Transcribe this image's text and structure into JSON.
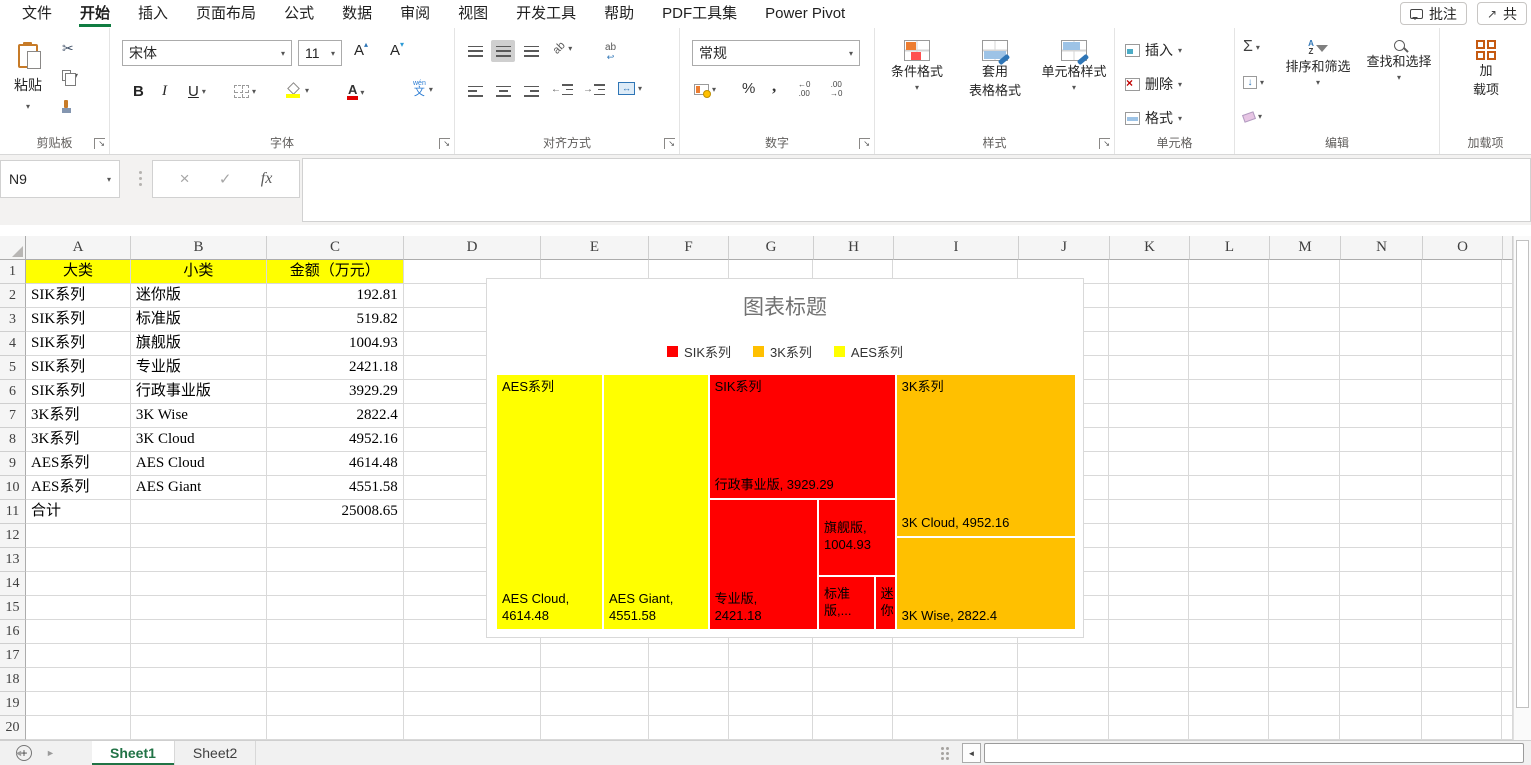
{
  "titlebar": {
    "tabs": [
      "文件",
      "开始",
      "插入",
      "页面布局",
      "公式",
      "数据",
      "审阅",
      "视图",
      "开发工具",
      "帮助",
      "PDF工具集",
      "Power Pivot"
    ],
    "active_tab": "开始",
    "comments_button": "批注",
    "share_button": "共"
  },
  "icons": {
    "dropdown": "▾",
    "launcher": "↘",
    "caret_up": "▴",
    "caret_down": "▾",
    "scissors": "✂",
    "merge_arrows": "↔",
    "wrap_ab": "ab",
    "wrap_return": "↩",
    "orient_ab": "ab",
    "indent_left": "←",
    "indent_right": "→",
    "sum": "Σ",
    "fill_down": "↓",
    "percent": "%",
    "comma": ",",
    "inc_decimal_top": "←0",
    "inc_decimal_bottom": ".00",
    "dec_decimal_top": ".00",
    "dec_decimal_bottom": "→0",
    "sort_a": "A",
    "sort_z": "Z",
    "cancel": "×",
    "enter": "✓",
    "fx": "fx",
    "nav_prev": "◄",
    "nav_next": "►",
    "scroll_left": "◄",
    "share_arrow": "↗"
  },
  "ribbon": {
    "clipboard": {
      "paste_label": "粘贴",
      "group_label": "剪贴板"
    },
    "font": {
      "font_name": "宋体",
      "font_size": "11",
      "bold": "B",
      "italic": "I",
      "underline": "U",
      "grow_letter": "A",
      "shrink_letter": "A",
      "color_letter": "A",
      "pinyin_top": "wén",
      "pinyin_bottom": "文",
      "group_label": "字体"
    },
    "alignment": {
      "group_label": "对齐方式"
    },
    "number": {
      "format_selected": "常规",
      "group_label": "数字"
    },
    "styles": {
      "conditional": "条件格式",
      "format_as_table_l1": "套用",
      "format_as_table_l2": "表格格式",
      "cell_styles": "单元格样式",
      "group_label": "样式"
    },
    "cells": {
      "insert": "插入",
      "delete": "删除",
      "format": "格式",
      "group_label": "单元格"
    },
    "editing": {
      "sort_filter": "排序和筛选",
      "find_select": "查找和选择",
      "group_label": "编辑"
    },
    "addins": {
      "button_l1": "加",
      "button_l2": "载项",
      "group_label": "加载项"
    }
  },
  "formula_bar": {
    "name_box": "N9",
    "formula_value": ""
  },
  "sheet": {
    "columns": [
      "A",
      "B",
      "C",
      "D",
      "E",
      "F",
      "G",
      "H",
      "I",
      "J",
      "K",
      "L",
      "M",
      "N",
      "O"
    ],
    "row_count": 20,
    "header_cells": [
      "大类",
      "小类",
      "金额（万元）"
    ],
    "header_fill": "#FFFF00",
    "data_rows": [
      {
        "row": 2,
        "A": "SIK系列",
        "B": "迷你版",
        "C": "192.81"
      },
      {
        "row": 3,
        "A": "SIK系列",
        "B": "标准版",
        "C": "519.82"
      },
      {
        "row": 4,
        "A": "SIK系列",
        "B": "旗舰版",
        "C": "1004.93"
      },
      {
        "row": 5,
        "A": "SIK系列",
        "B": "专业版",
        "C": "2421.18"
      },
      {
        "row": 6,
        "A": "SIK系列",
        "B": "行政事业版",
        "C": "3929.29"
      },
      {
        "row": 7,
        "A": "3K系列",
        "B": "3K Wise",
        "C": "2822.4"
      },
      {
        "row": 8,
        "A": "3K系列",
        "B": "3K Cloud",
        "C": "4952.16"
      },
      {
        "row": 9,
        "A": "AES系列",
        "B": "AES  Cloud",
        "C": "4614.48"
      },
      {
        "row": 10,
        "A": "AES系列",
        "B": "AES  Giant",
        "C": "4551.58"
      },
      {
        "row": 11,
        "A": "合计",
        "B": "",
        "C": "25008.65"
      }
    ],
    "tabs": [
      "Sheet1",
      "Sheet2"
    ],
    "active_sheet": "Sheet1",
    "new_sheet_glyph": "+"
  },
  "chart_data": {
    "type": "treemap",
    "title": "图表标题",
    "legend_position": "top",
    "legend": [
      {
        "name": "SIK系列",
        "color": "#FF0000"
      },
      {
        "name": "3K系列",
        "color": "#FFC000"
      },
      {
        "name": "AES系列",
        "color": "#FFFF00"
      }
    ],
    "groups": [
      {
        "name": "SIK系列",
        "color": "#FF0000",
        "items": [
          {
            "label": "迷你版",
            "value": 192.81
          },
          {
            "label": "标准版",
            "value": 519.82
          },
          {
            "label": "旗舰版",
            "value": 1004.93
          },
          {
            "label": "专业版",
            "value": 2421.18
          },
          {
            "label": "行政事业版",
            "value": 3929.29
          }
        ]
      },
      {
        "name": "3K系列",
        "color": "#FFC000",
        "items": [
          {
            "label": "3K Wise",
            "value": 2822.4
          },
          {
            "label": "3K Cloud",
            "value": 4952.16
          }
        ]
      },
      {
        "name": "AES系列",
        "color": "#FFFF00",
        "items": [
          {
            "label": "AES Cloud",
            "value": 4614.48
          },
          {
            "label": "AES Giant",
            "value": 4551.58
          }
        ]
      }
    ],
    "total": 25008.65,
    "cells": [
      {
        "id": "aes-cloud",
        "color": "#FFFF00",
        "x": 0,
        "y": 0,
        "w": 18.45,
        "h": 100,
        "group_label": "AES系列",
        "text": "AES Cloud,\n 4614.48",
        "valign": "bottom"
      },
      {
        "id": "aes-giant",
        "color": "#FFFF00",
        "x": 18.45,
        "y": 0,
        "w": 18.2,
        "h": 100,
        "group_label": "",
        "text": "AES Giant,\n 4551.58",
        "valign": "bottom"
      },
      {
        "id": "sik-admin",
        "color": "#FF0000",
        "x": 36.65,
        "y": 0,
        "w": 32.26,
        "h": 48.7,
        "group_label": "SIK系列",
        "text": "行政事业版, 3929.29",
        "valign": "bottom"
      },
      {
        "id": "sik-pro",
        "color": "#FF0000",
        "x": 36.65,
        "y": 48.7,
        "w": 18.87,
        "h": 51.3,
        "group_label": "",
        "text": "专业版,\n2421.18",
        "valign": "bottom"
      },
      {
        "id": "sik-flag",
        "color": "#FF0000",
        "x": 55.52,
        "y": 48.7,
        "w": 13.39,
        "h": 30.02,
        "group_label": "",
        "text": "旗舰版,\n1004.93",
        "valign": "middle"
      },
      {
        "id": "sik-std",
        "color": "#FF0000",
        "x": 55.52,
        "y": 78.72,
        "w": 9.77,
        "h": 21.28,
        "group_label": "",
        "text": "标准版,...",
        "valign": "middle"
      },
      {
        "id": "sik-mini",
        "color": "#FF0000",
        "x": 65.29,
        "y": 78.72,
        "w": 3.62,
        "h": 21.28,
        "group_label": "",
        "text": "迷你",
        "valign": "middle"
      },
      {
        "id": "3k-cloud",
        "color": "#FFC000",
        "x": 68.91,
        "y": 0,
        "w": 31.09,
        "h": 63.7,
        "group_label": "3K系列",
        "text": "3K Cloud, 4952.16",
        "valign": "bottom"
      },
      {
        "id": "3k-wise",
        "color": "#FFC000",
        "x": 68.91,
        "y": 63.7,
        "w": 31.09,
        "h": 36.3,
        "group_label": "",
        "text": "3K Wise, 2822.4",
        "valign": "bottom"
      }
    ]
  }
}
